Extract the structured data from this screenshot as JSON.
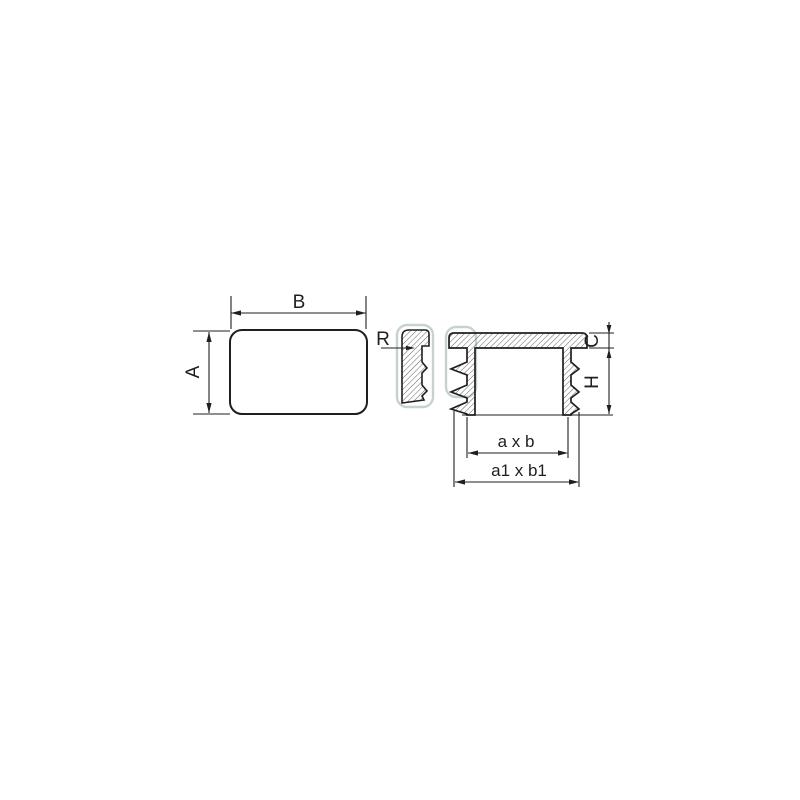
{
  "diagram": {
    "type": "technical-drawing-end-cap",
    "labels": {
      "plan_width": "B",
      "plan_height": "A",
      "corner_radius": "R",
      "flange_thickness": "C",
      "insert_depth": "H",
      "inner_size": "a x b",
      "outer_size": "a1 x b1"
    },
    "views": {
      "plan_view": "rounded rectangle top view",
      "detail_view": "wall section detail",
      "section_view": "cap cross-section with ribs"
    }
  },
  "colors": {
    "background": "#ffffff",
    "line": "#1f1f1f",
    "hatch": "#3a3a3a",
    "highlight_outline": "#c6d2ce"
  }
}
